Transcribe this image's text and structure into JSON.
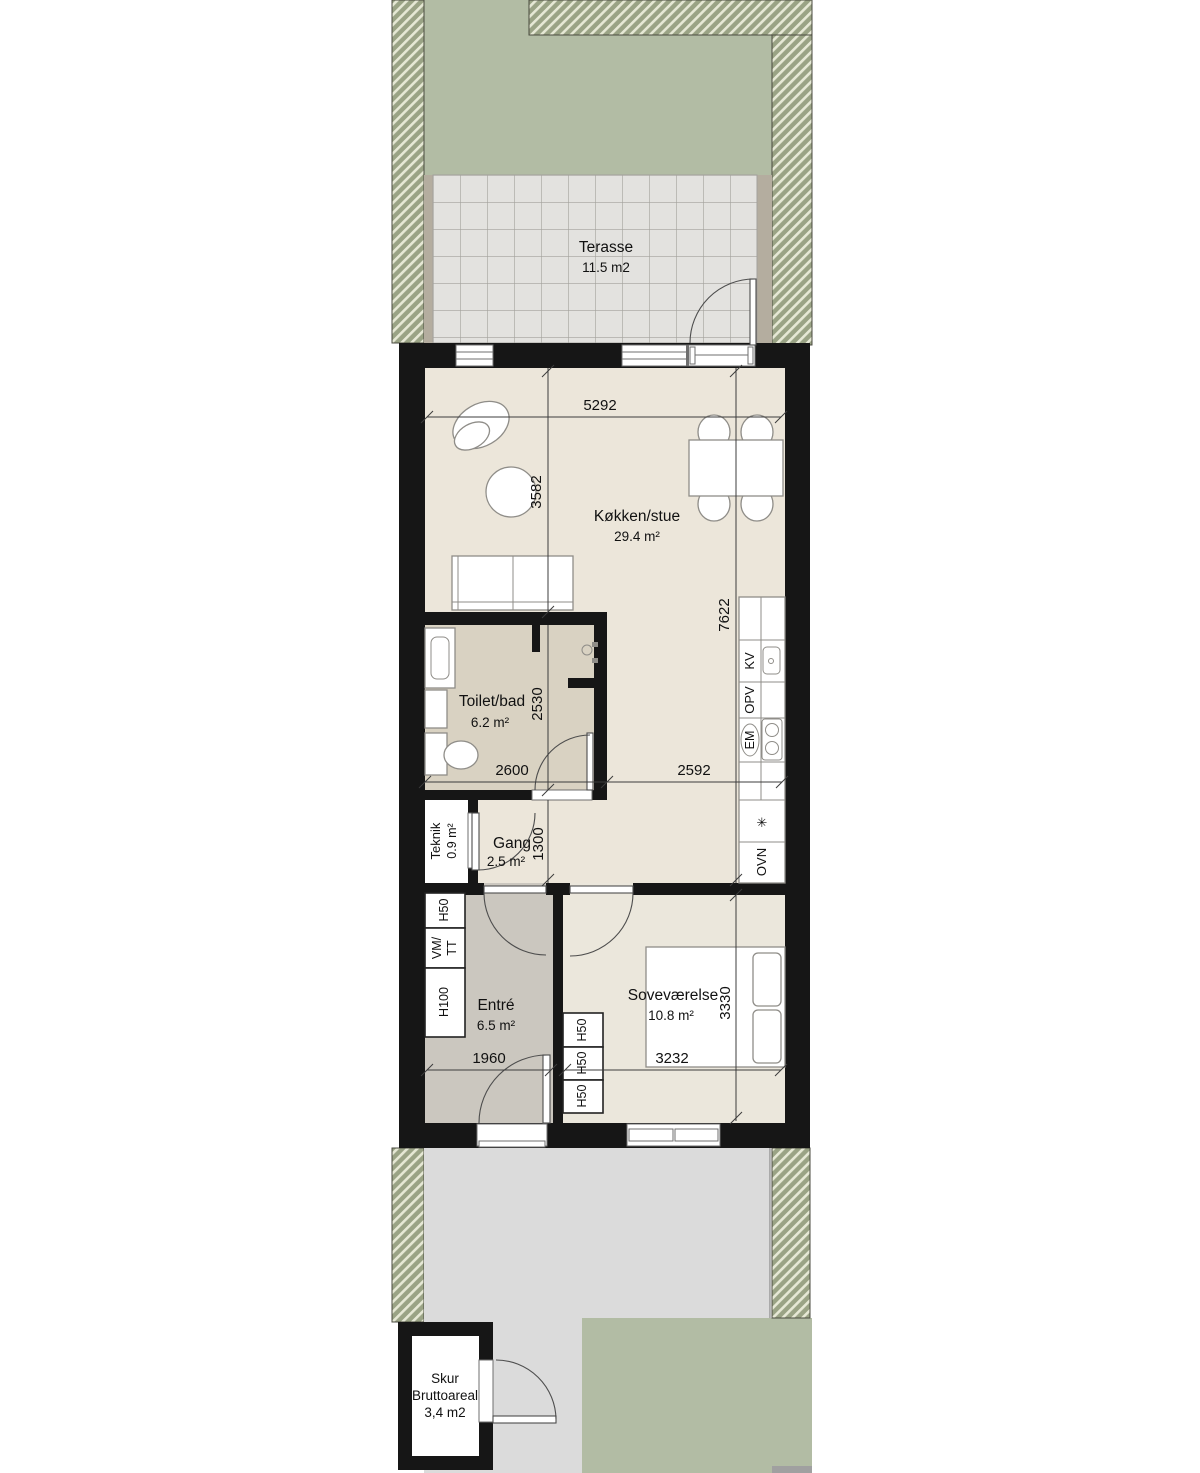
{
  "terrace": {
    "name": "Terasse",
    "area": "11.5 m2"
  },
  "rooms": {
    "kitchen": {
      "name": "Køkken/stue",
      "area": "29.4 m²"
    },
    "toilet": {
      "name": "Toilet/bad",
      "area": "6.2 m²"
    },
    "teknik": {
      "name": "Teknik",
      "area": "0.9 m²"
    },
    "gang": {
      "name": "Gang",
      "area": "2.5 m²"
    },
    "entre": {
      "name": "Entré",
      "area": "6.5 m²"
    },
    "bedroom": {
      "name": "Soveværelse",
      "area": "10.8 m²"
    }
  },
  "shed": {
    "name": "Skur",
    "label": "Bruttoareal",
    "area": "3,4 m2"
  },
  "dims": {
    "d5292": "5292",
    "d3582": "3582",
    "d7622": "7622",
    "d2600": "2600",
    "d2530": "2530",
    "d2592": "2592",
    "d1300": "1300",
    "d1960": "1960",
    "d3232": "3232",
    "d3330": "3330"
  },
  "kitchen_units": {
    "kv": "KV",
    "opv": "OPV",
    "em": "EM",
    "freezer": "✳",
    "ovn": "OVN"
  },
  "entre_cabinets": {
    "h50": "H50",
    "vm": "VM/",
    "tt": "TT",
    "h100": "H100"
  },
  "bedroom_cabinets": {
    "c1": "H50",
    "c2": "H50",
    "c3": "H50"
  },
  "colors": {
    "lawn": "#b2bca4",
    "hatch_stripe": "#e6e8d5",
    "terrace_tile": "#e3e2df",
    "wall": "#161616",
    "floor_main": "#ece6da",
    "floor_toilet": "#d9d2c2",
    "floor_entre": "#cbc7bf",
    "floor_bedroom": "#ebe7dc",
    "path": "#dbdbdb"
  }
}
